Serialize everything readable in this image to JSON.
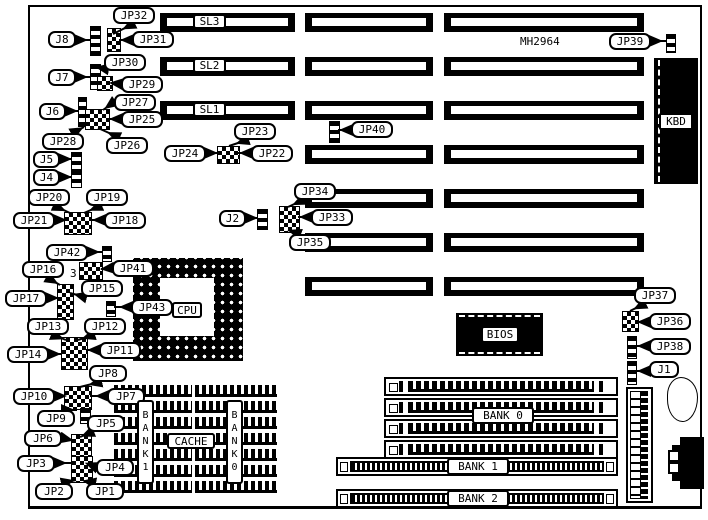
{
  "board": {
    "chip_marking": "MH2964",
    "pin_number_note": "3"
  },
  "labels": {
    "jp1": "JP1",
    "jp2": "JP2",
    "jp3": "JP3",
    "jp4": "JP4",
    "jp5": "JP5",
    "jp6": "JP6",
    "jp7": "JP7",
    "jp8": "JP8",
    "jp9": "JP9",
    "jp10": "JP10",
    "jp11": "JP11",
    "jp12": "JP12",
    "jp13": "JP13",
    "jp14": "JP14",
    "jp15": "JP15",
    "jp16": "JP16",
    "jp17": "JP17",
    "jp18": "JP18",
    "jp19": "JP19",
    "jp20": "JP20",
    "jp21": "JP21",
    "jp22": "JP22",
    "jp23": "JP23",
    "jp24": "JP24",
    "jp25": "JP25",
    "jp26": "JP26",
    "jp27": "JP27",
    "jp28": "JP28",
    "jp29": "JP29",
    "jp30": "JP30",
    "jp31": "JP31",
    "jp32": "JP32",
    "jp33": "JP33",
    "jp34": "JP34",
    "jp35": "JP35",
    "jp36": "JP36",
    "jp37": "JP37",
    "jp38": "JP38",
    "jp39": "JP39",
    "jp40": "JP40",
    "jp41": "JP41",
    "jp42": "JP42",
    "jp43": "JP43",
    "j1": "J1",
    "j2": "J2",
    "j4": "J4",
    "j5": "J5",
    "j6": "J6",
    "j7": "J7",
    "j8": "J8",
    "sl1": "SL1",
    "sl2": "SL2",
    "sl3": "SL3"
  },
  "components": {
    "cpu": "CPU",
    "bios": "BIOS",
    "kbd": "KBD",
    "cache": "CACHE",
    "bank0": "BANK 0",
    "bank1": "BANK 1",
    "bank2": "BANK 2",
    "cache_bank1_vertical": "BANK1",
    "cache_bank0_vertical": "BANK0"
  },
  "colors": {
    "ink": "#000000",
    "paper": "#ffffff"
  }
}
